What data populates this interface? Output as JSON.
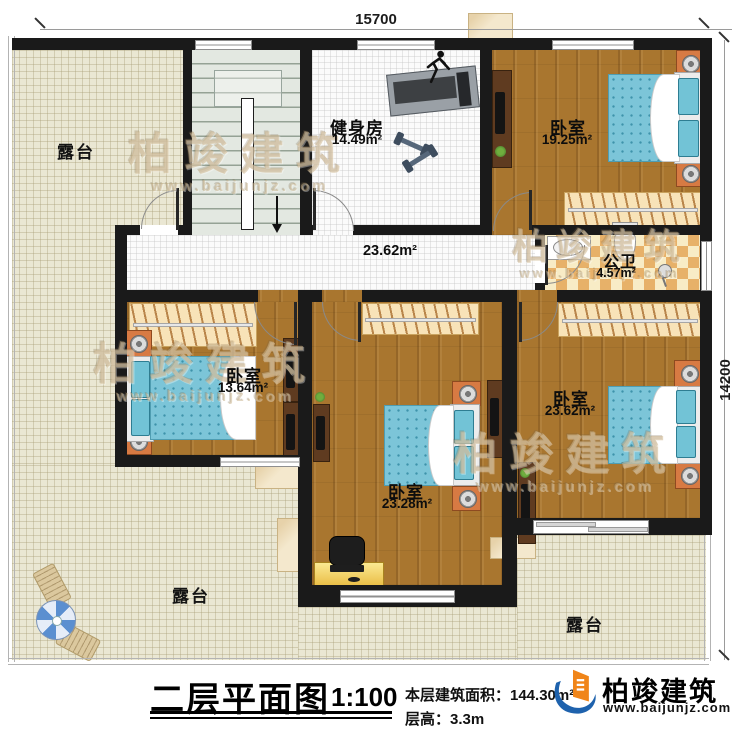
{
  "dimensions": {
    "width_label": "15700",
    "height_label": "14200"
  },
  "terraces": {
    "top_left": "露台",
    "bottom_left": "露台",
    "bottom_right": "露台"
  },
  "rooms": {
    "gym": {
      "name": "健身房",
      "area": "14.49m²"
    },
    "bedroom_top_right": {
      "name": "卧室",
      "area": "19.25m²"
    },
    "bathroom": {
      "name": "公卫",
      "area": "4.57m²"
    },
    "hallway": {
      "area": "23.62m²"
    },
    "bedroom_left": {
      "name": "卧室",
      "area": "13.64m²"
    },
    "bedroom_center": {
      "name": "卧室",
      "area": "23.28m²"
    },
    "bedroom_right": {
      "name": "卧室",
      "area": "23.62m²"
    }
  },
  "title": {
    "name": "二层平面图",
    "scale": "1:100",
    "floor_area_line": "本层建筑面积：144.30m²",
    "floor_height_line": "层高：3.3m"
  },
  "brand": {
    "name": "柏竣建筑",
    "website": "www.baijunjz.com"
  },
  "watermark": {
    "text": "柏竣建筑",
    "website": "www.baijunjz.com"
  },
  "colors": {
    "wall": "#1a1a1a",
    "wood": "#a9762f",
    "terrace": "#eae7d3",
    "mattress": "#7cc5d8",
    "accent_orange": "#f08519",
    "accent_blue": "#1e62ad"
  }
}
